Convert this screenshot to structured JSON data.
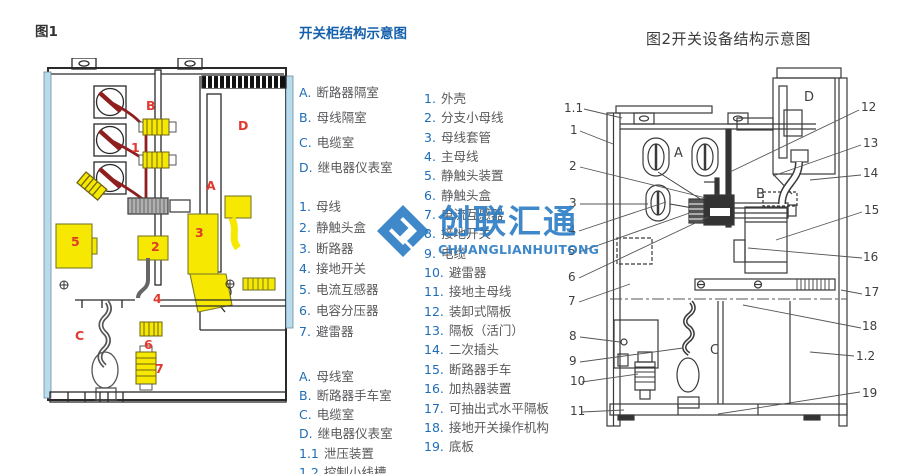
{
  "colors": {
    "accent_blue": "#1560ac",
    "key_blue": "#1f6db8",
    "text_gray": "#58595b",
    "label_red": "#e03a2e",
    "watermark_blue": "#2b7cc4",
    "component_yellow": "#f6e800",
    "panel_lightblue": "#b9dcec",
    "busbar_darkred": "#8f1f1f",
    "line_dark": "#333333"
  },
  "figure1": {
    "caption": "图1",
    "labels": [
      {
        "text": "B",
        "x": 106,
        "y": 42
      },
      {
        "text": "1",
        "x": 91,
        "y": 84
      },
      {
        "text": "D",
        "x": 198,
        "y": 62
      },
      {
        "text": "A",
        "x": 166,
        "y": 122
      },
      {
        "text": "5",
        "x": 31,
        "y": 178
      },
      {
        "text": "2",
        "x": 111,
        "y": 183
      },
      {
        "text": "3",
        "x": 155,
        "y": 169
      },
      {
        "text": "4",
        "x": 113,
        "y": 235
      },
      {
        "text": "C",
        "x": 35,
        "y": 272
      },
      {
        "text": "6",
        "x": 104,
        "y": 281
      },
      {
        "text": "7",
        "x": 115,
        "y": 305
      }
    ]
  },
  "legend_panel": {
    "title": "开关柜结构示意图",
    "compartments": [
      {
        "key": "A.",
        "label": "断路器隔室"
      },
      {
        "key": "B.",
        "label": "母线隔室"
      },
      {
        "key": "C.",
        "label": "电缆室"
      },
      {
        "key": "D.",
        "label": "继电器仪表室"
      }
    ],
    "parts": [
      {
        "key": "1.",
        "label": "母线"
      },
      {
        "key": "2.",
        "label": "静触头盒"
      },
      {
        "key": "3.",
        "label": "断路器"
      },
      {
        "key": "4.",
        "label": "接地开关"
      },
      {
        "key": "5.",
        "label": "电流互感器"
      },
      {
        "key": "6.",
        "label": "电容分压器"
      },
      {
        "key": "7.",
        "label": "避雷器"
      }
    ],
    "compartments2": [
      {
        "key": "A.",
        "label": "母线室"
      },
      {
        "key": "B.",
        "label": "断路器手车室"
      },
      {
        "key": "C.",
        "label": "电缆室"
      },
      {
        "key": "D.",
        "label": "继电器仪表室"
      },
      {
        "key": "1.1",
        "label": "泄压装置"
      },
      {
        "key": "1.2",
        "label": "控制小线槽"
      }
    ]
  },
  "legend2": {
    "items": [
      {
        "key": "1.",
        "label": "外壳"
      },
      {
        "key": "2.",
        "label": "分支小母线"
      },
      {
        "key": "3.",
        "label": "母线套管"
      },
      {
        "key": "4.",
        "label": "主母线"
      },
      {
        "key": "5.",
        "label": "静触头装置"
      },
      {
        "key": "6.",
        "label": "静触头盒"
      },
      {
        "key": "7.",
        "label": "电流互感器"
      },
      {
        "key": "8.",
        "label": "接地开关"
      },
      {
        "key": "9.",
        "label": "电缆"
      },
      {
        "key": "10.",
        "label": "避雷器"
      },
      {
        "key": "11.",
        "label": "接地主母线"
      },
      {
        "key": "12.",
        "label": "装卸式隔板"
      },
      {
        "key": "13.",
        "label": "隔板（活门）"
      },
      {
        "key": "14.",
        "label": "二次插头"
      },
      {
        "key": "15.",
        "label": "断路器手车"
      },
      {
        "key": "16.",
        "label": "加热器装置"
      },
      {
        "key": "17.",
        "label": "可抽出式水平隔板"
      },
      {
        "key": "18.",
        "label": "接地开关操作机构"
      },
      {
        "key": "19.",
        "label": "底板"
      }
    ]
  },
  "figure2": {
    "title": "图2开关设备结构示意图",
    "letters": [
      {
        "text": "A",
        "x": 116,
        "y": 95
      },
      {
        "text": "B",
        "x": 198,
        "y": 136
      },
      {
        "text": "C",
        "x": 152,
        "y": 292
      },
      {
        "text": "D",
        "x": 246,
        "y": 39
      }
    ],
    "callouts": [
      {
        "text": "1.1",
        "x": 6,
        "y": 50
      },
      {
        "text": "1",
        "x": 12,
        "y": 72
      },
      {
        "text": "2",
        "x": 11,
        "y": 108
      },
      {
        "text": "3",
        "x": 11,
        "y": 145
      },
      {
        "text": "4",
        "x": 10,
        "y": 172
      },
      {
        "text": "5",
        "x": 10,
        "y": 193
      },
      {
        "text": "6",
        "x": 10,
        "y": 219
      },
      {
        "text": "7",
        "x": 10,
        "y": 243
      },
      {
        "text": "8",
        "x": 11,
        "y": 278
      },
      {
        "text": "9",
        "x": 11,
        "y": 303
      },
      {
        "text": "10",
        "x": 12,
        "y": 323
      },
      {
        "text": "11",
        "x": 12,
        "y": 353
      },
      {
        "text": "12",
        "x": 303,
        "y": 49
      },
      {
        "text": "13",
        "x": 305,
        "y": 85
      },
      {
        "text": "14",
        "x": 305,
        "y": 115
      },
      {
        "text": "15",
        "x": 306,
        "y": 152
      },
      {
        "text": "16",
        "x": 305,
        "y": 199
      },
      {
        "text": "17",
        "x": 306,
        "y": 234
      },
      {
        "text": "18",
        "x": 304,
        "y": 268
      },
      {
        "text": "1.2",
        "x": 298,
        "y": 298
      },
      {
        "text": "19",
        "x": 304,
        "y": 335
      }
    ]
  },
  "watermark": {
    "text": "创联汇通",
    "subtext": "CHUANGLIANHUITONG"
  }
}
